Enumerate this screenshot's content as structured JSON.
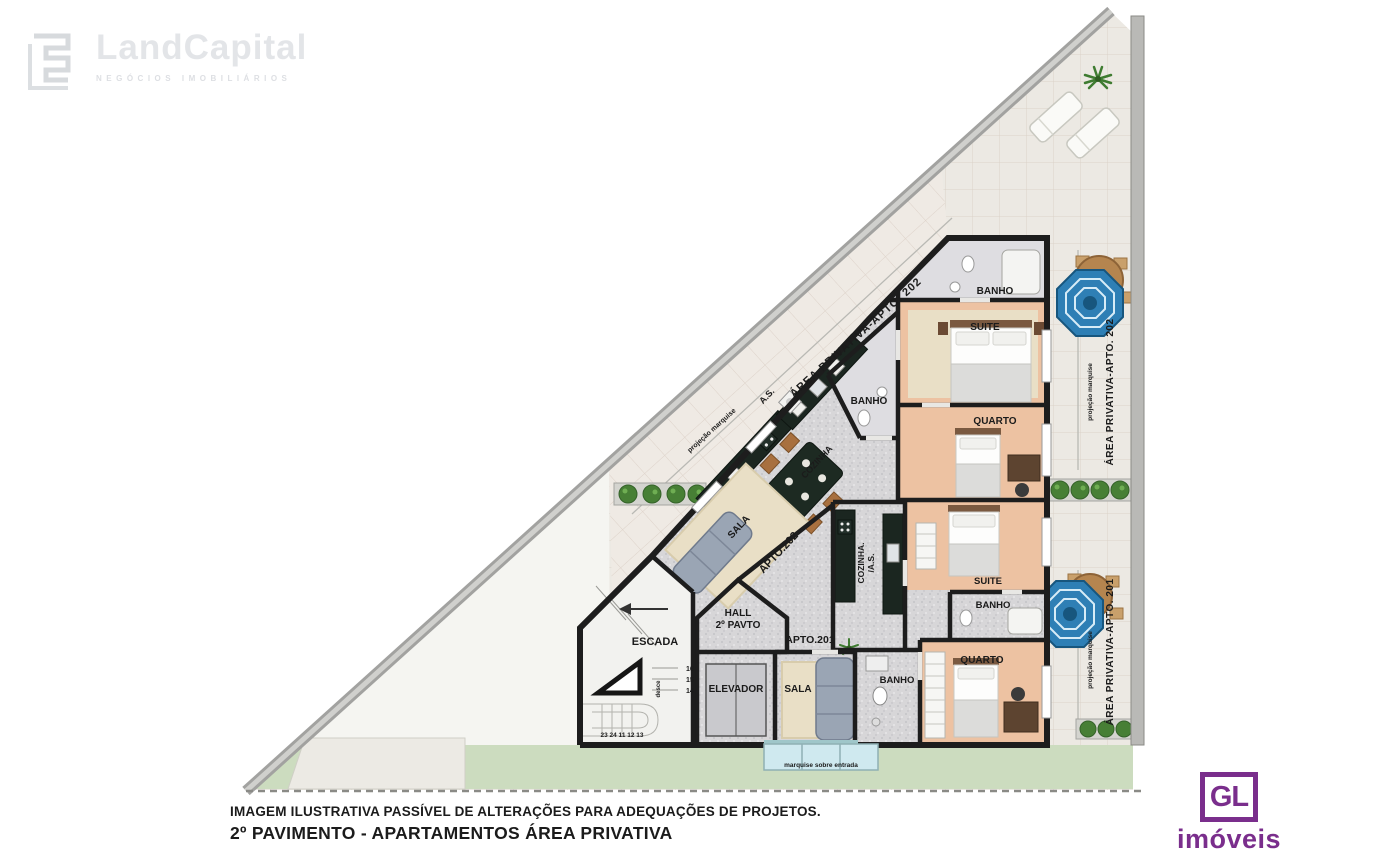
{
  "watermark": {
    "brand": "LandCapital",
    "tagline": "NEGÓCIOS IMOBILIÁRIOS"
  },
  "footer": {
    "disclaimer": "IMAGEM ILUSTRATIVA PASSÍVEL DE ALTERAÇÕES PARA ADEQUAÇÕES DE PROJETOS.",
    "title": "2º PAVIMENTO - APARTAMENTOS ÁREA PRIVATIVA"
  },
  "agency": {
    "initials": "GL",
    "name": "imóveis",
    "brand_color": "#7a2e8c"
  },
  "plan": {
    "outdoor": {
      "area_apto202_diagonal": "ÁREA PRIVATIVA-APTO. 202",
      "area_apto202_right": "ÁREA PRIVATIVA-APTO. 202",
      "area_apto201_right": "ÁREA PRIVATIVA-APTO. 201",
      "projecao_marquise": "projeção marquise",
      "marquise_entrada": "marquise  sobre  entrada"
    },
    "apto202": {
      "id": "APTO.202",
      "banho_top": "BANHO",
      "suite": "SUITE",
      "quarto": "QUARTO",
      "banho": "BANHO",
      "cozinha": "COZINHA",
      "area_servico": "A.S.",
      "sala": "SALA"
    },
    "apto201": {
      "id": "APTO.201",
      "cozinha_line1": "COZINHA.",
      "cozinha_line2": "/A.S.",
      "suite": "SUITE",
      "banho_suite": "BANHO",
      "quarto": "QUARTO",
      "banho": "BANHO",
      "sala": "SALA"
    },
    "core": {
      "hall_line1": "HALL",
      "hall_line2": "2º PAVTO",
      "escada": "ESCADA",
      "elevador": "ELEVADOR",
      "desce": "desce",
      "step_a": "16",
      "step_b": "15",
      "step_c": "14",
      "steps_row": "23 24 11 12 13"
    },
    "colors": {
      "wall": "#1d1d1d",
      "tile": "#ece9e3",
      "grass": "#ccdcbf",
      "granite": "#d7d6d8",
      "wood_floor": "#edc2a2",
      "umbrella": "#2e7fb5",
      "glass": "#cfe9ef"
    }
  }
}
